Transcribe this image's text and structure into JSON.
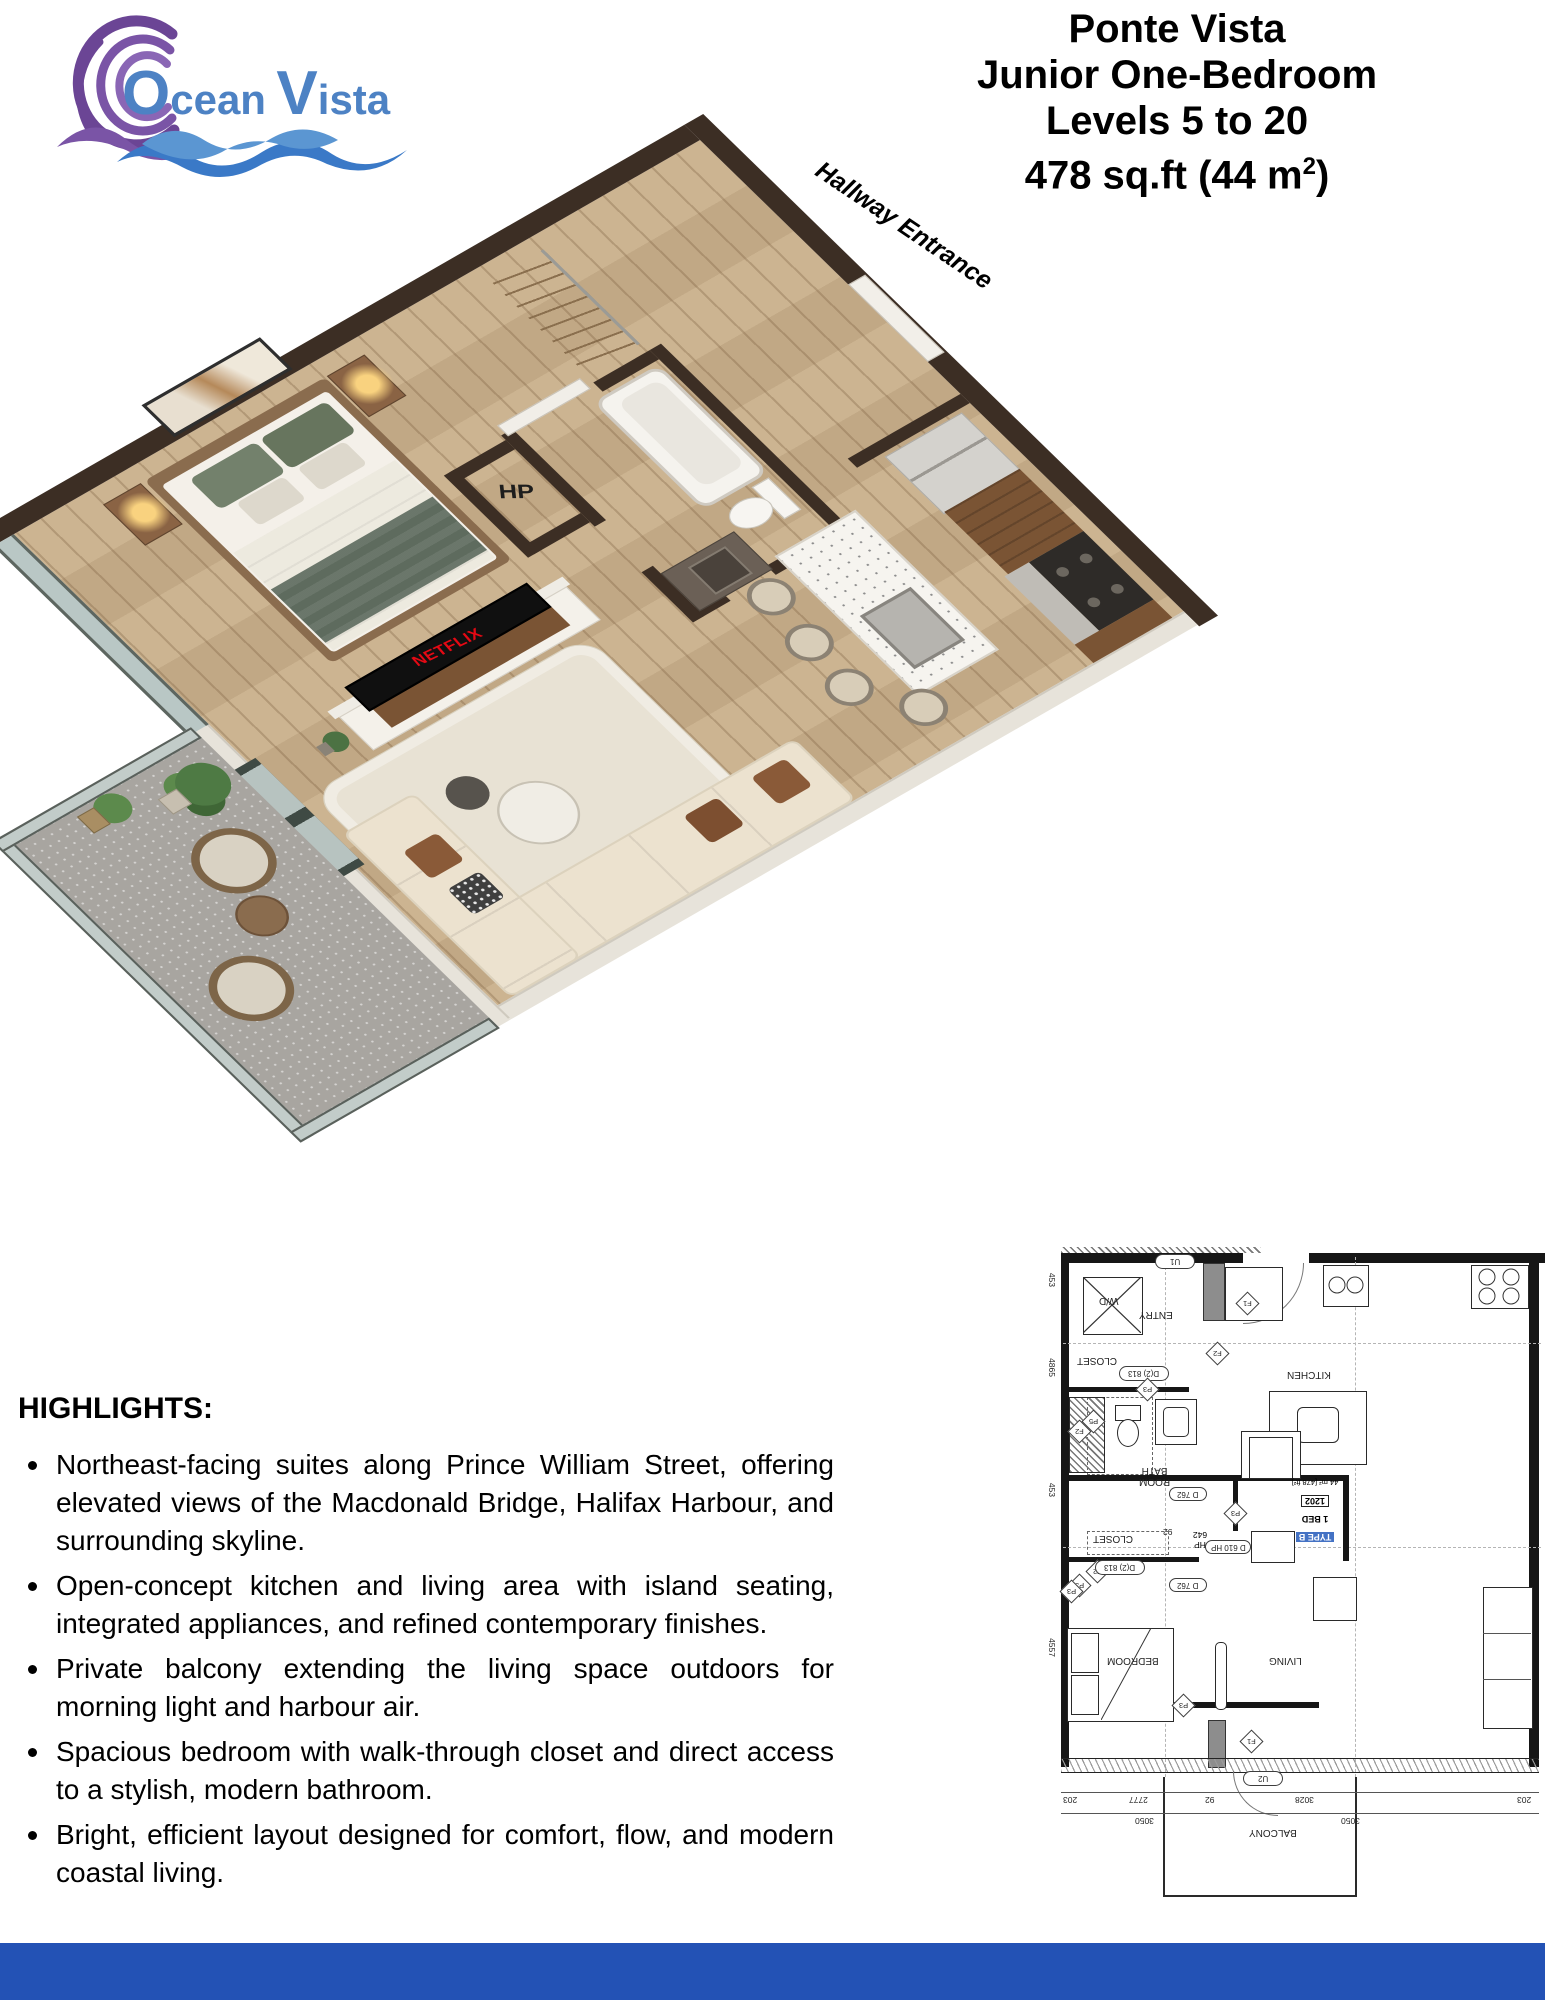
{
  "logo": {
    "word1": "Ocean",
    "word2": "Vista"
  },
  "header": {
    "line1": "Ponte Vista",
    "line2": "Junior One-Bedroom",
    "line3": "Levels 5 to 20",
    "area_prefix": "478 sq.ft (44 m",
    "area_sup": "2",
    "area_suffix": ")"
  },
  "plan3d": {
    "hallway_label": "Hallway Entrance",
    "hp_label": "HP",
    "tv_brand": "NETFLIX"
  },
  "highlights": {
    "heading": "HIGHLIGHTS:",
    "items": [
      "Northeast-facing suites along Prince William Street, offering elevated views of the Macdonald Bridge, Halifax Harbour, and surrounding skyline.",
      "Open-concept kitchen and living area with island seating, integrated appliances, and refined contemporary finishes.",
      "Private balcony extending the living space outdoors for morning light and harbour air.",
      "Spacious bedroom with walk-through closet and direct access to a stylish, modern bathroom.",
      "Bright, efficient layout designed for comfort, flow, and modern coastal living."
    ]
  },
  "plan2d": {
    "wd": "W/D",
    "entry": "ENTRY",
    "closet": "CLOSET",
    "kitchen": "KITCHEN",
    "bath_line1": "BATH",
    "bath_line2": "ROOM",
    "bedroom": "BEDROOM",
    "living": "LIVING",
    "balcony": "BALCONY",
    "u1": "U1",
    "u2": "U2",
    "f1": "F1",
    "f2": "F2",
    "p3": "P3",
    "p5": "P5",
    "d762": "D 762",
    "d2813": "D(2) 813",
    "d610": "D 610 HP",
    "hp": "HP",
    "hp_num": "642",
    "dim92": "92",
    "stamp_type": "TYPE B",
    "stamp_bed": "1 BED",
    "stamp_unit": "1202",
    "stamp_area": "44 m² [478 ft²]",
    "dims_bottom": [
      "203",
      "2777",
      "92",
      "3028",
      "203"
    ],
    "dims_bottom2": [
      "3050",
      "3050"
    ],
    "dims_left": [
      "453",
      "4865",
      "453",
      "4557"
    ]
  },
  "colors": {
    "accent_blue_bar": "#2352b5",
    "logo_blue": "#4d82c4",
    "logo_purple": "#6b4595",
    "netflix_red": "#e50914",
    "wall_brown": "#3c2e24",
    "floor_wood": "#c9af8a"
  }
}
